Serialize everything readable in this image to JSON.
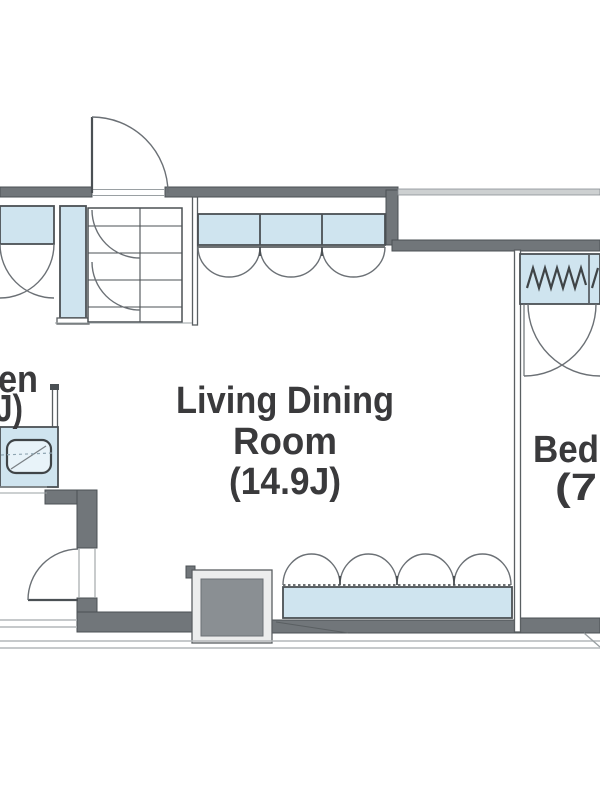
{
  "page": {
    "type": "apartment-floor-plan",
    "background": "#ffffff"
  },
  "labels": {
    "living_dining_room": {
      "line1": "Living Dining",
      "line2": "Room",
      "line3": "(14.9J)"
    },
    "bedroom": {
      "line1": "Bed",
      "line2": "(7"
    },
    "kitchen": {
      "line1": "en",
      "line2": "J)"
    }
  },
  "colors": {
    "wall": "#71767a",
    "wall_edge": "#4b5054",
    "glass": "#cfe4ef",
    "glass_light": "#e8f3f9",
    "pillar": "#8a8f93",
    "text": "#3a3a3c",
    "swing_arc": "#6b7075",
    "light_line": "#b3b7ba"
  },
  "fixtures": [
    {
      "name": "entrance-door-swing"
    },
    {
      "name": "hall-closet"
    },
    {
      "name": "tall-closet"
    },
    {
      "name": "shoe-cabinet"
    },
    {
      "name": "triple-casement-window"
    },
    {
      "name": "bedroom-hanger-closet"
    },
    {
      "name": "closet-door-swings"
    },
    {
      "name": "kitchen-sink-counter"
    },
    {
      "name": "bathroom-door-swing"
    },
    {
      "name": "structural-pillar"
    },
    {
      "name": "balcony-sliding-window"
    },
    {
      "name": "balcony-edge"
    }
  ]
}
